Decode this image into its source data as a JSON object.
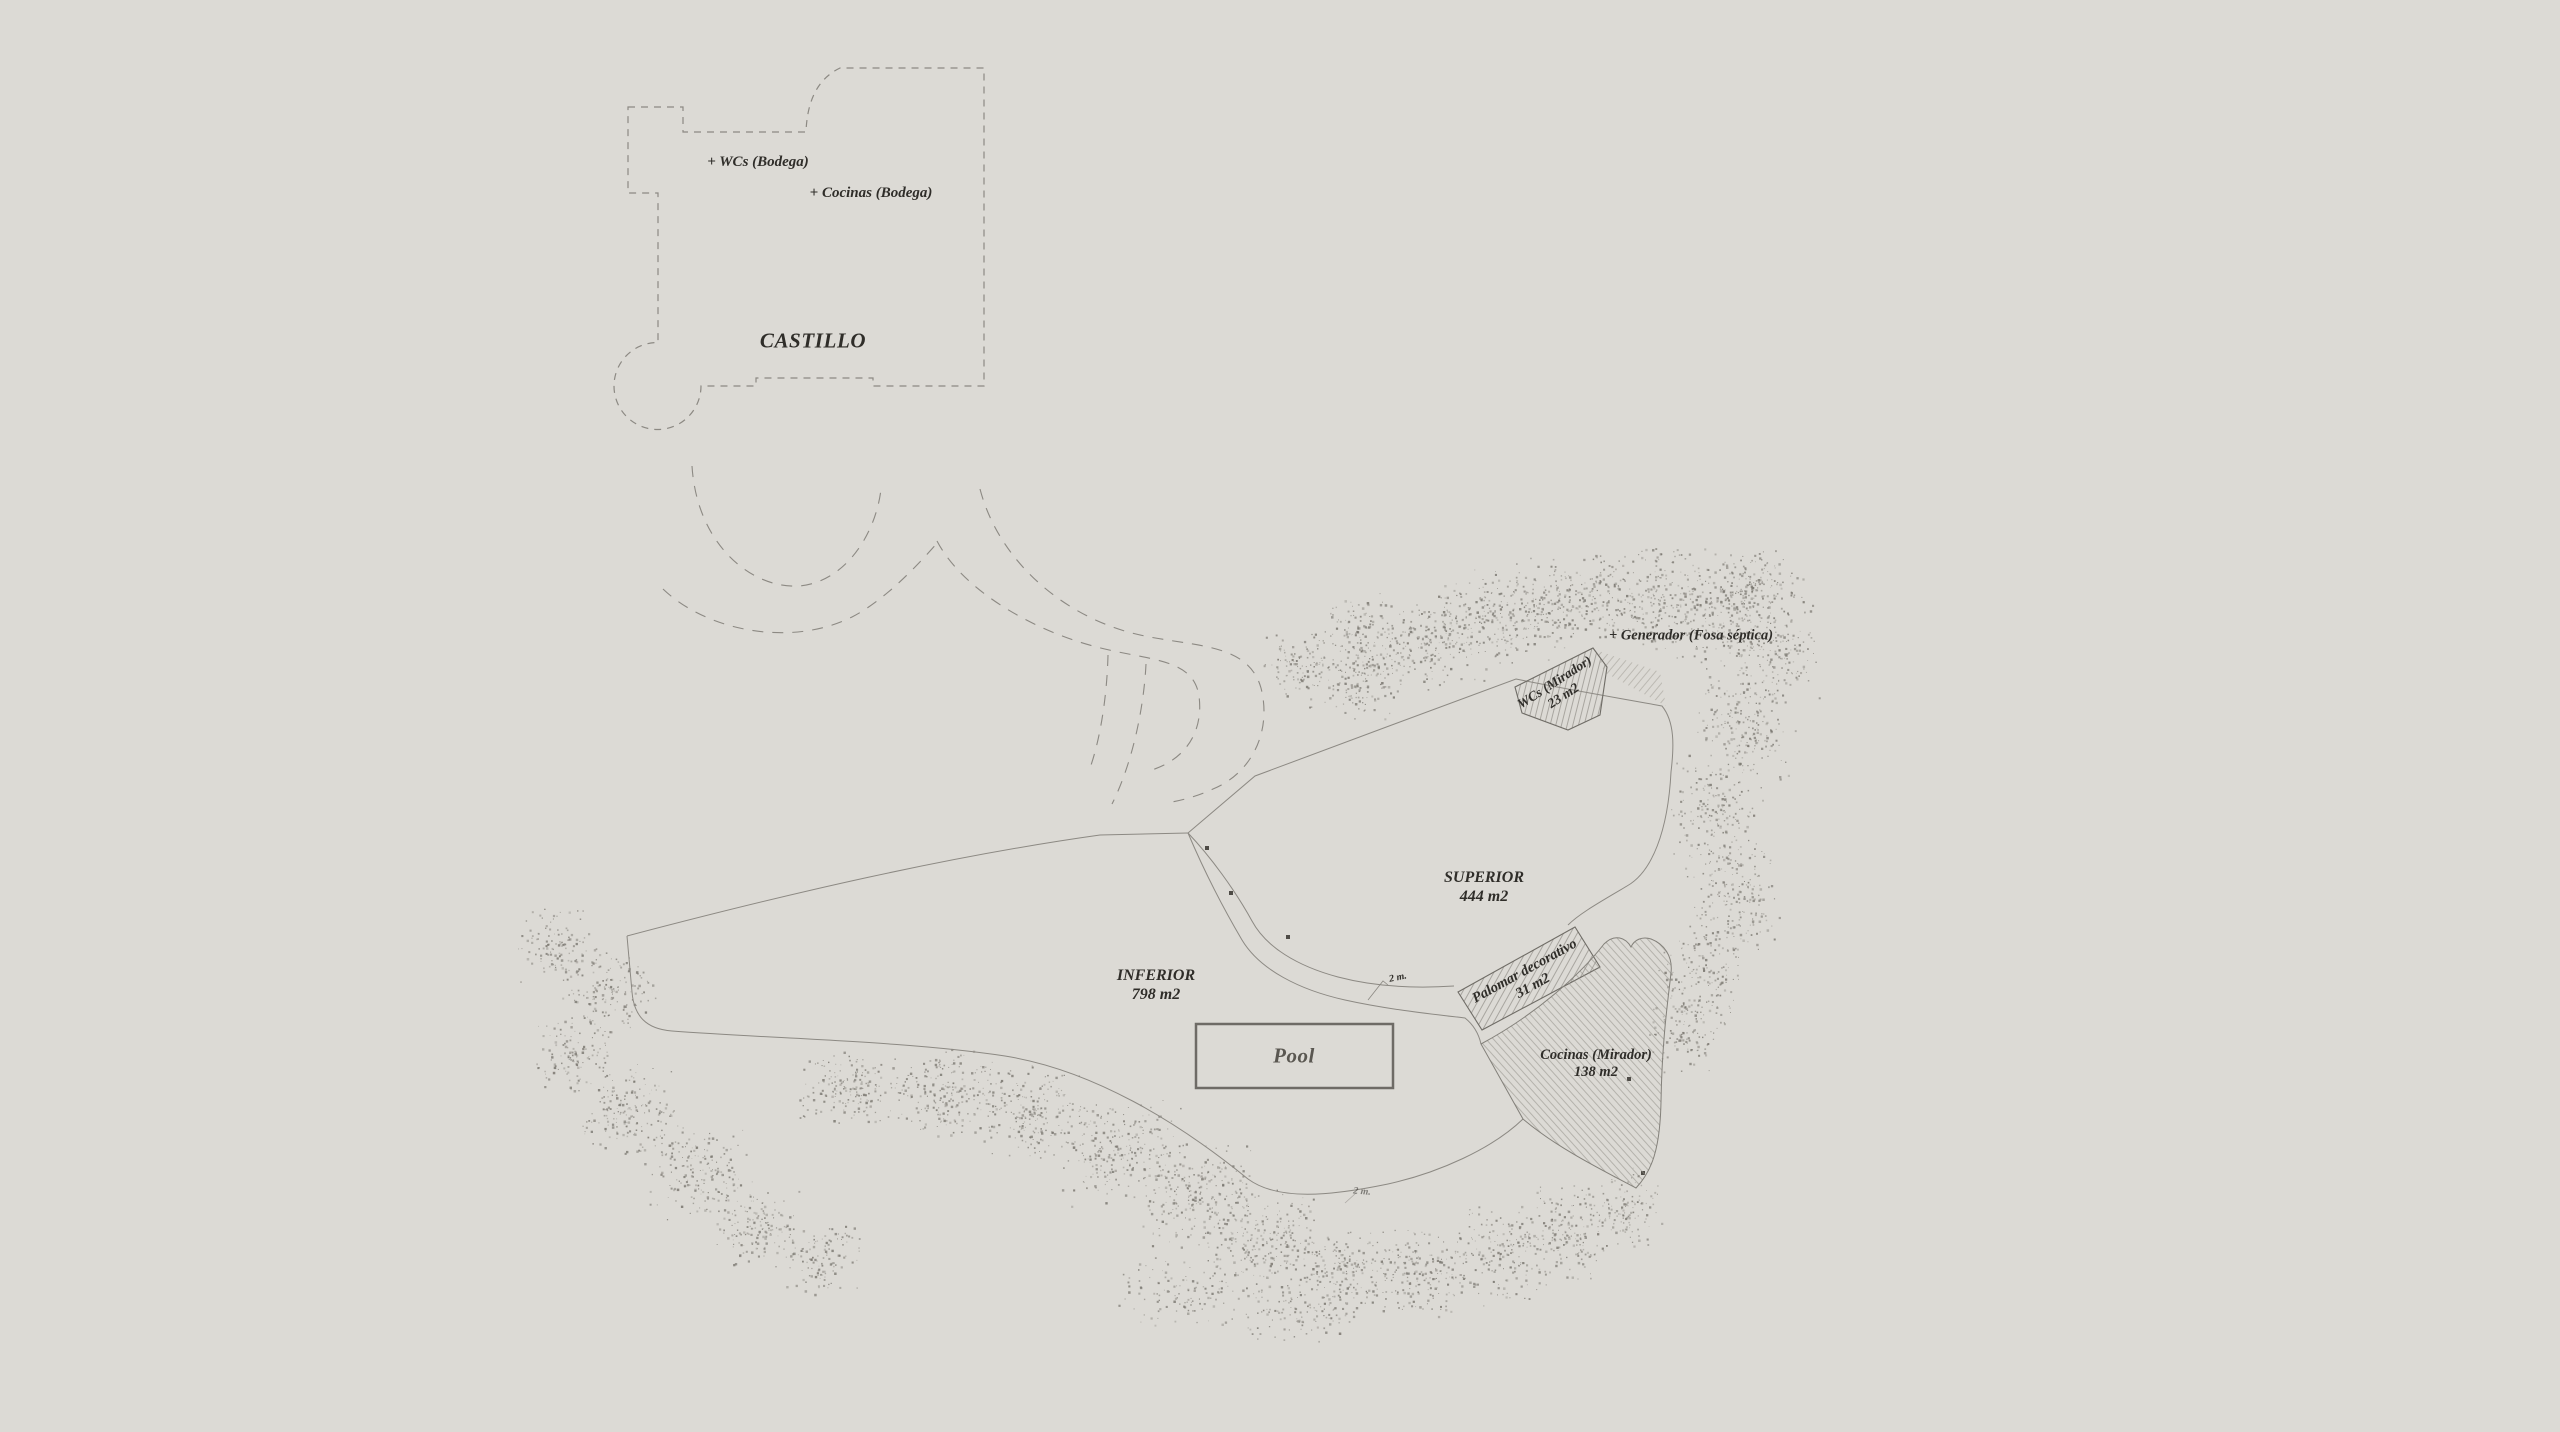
{
  "plan": {
    "castle_label": "CASTILLO",
    "wcs_bodega_label": "+ WCs (Bodega)",
    "cocinas_bodega_label": "+ Cocinas (Bodega)",
    "generador_label": "+ Generador (Fosa séptica)",
    "pool_label": "Pool",
    "zones": {
      "superior": {
        "name": "SUPERIOR",
        "area": "444 m2"
      },
      "inferior": {
        "name": "INFERIOR",
        "area": "798 m2"
      },
      "wcs_mirador": {
        "name": "WCs (Mirador)",
        "area": "23 m2"
      },
      "palomar": {
        "name": "Palomar decorativo",
        "area": "31 m2"
      },
      "cocinas_mirador": {
        "name": "Cocinas (Mirador)",
        "area": "138 m2"
      }
    },
    "path_width_labels": [
      "2 m.",
      "2 m."
    ],
    "colors": {
      "background": "#dcdad5",
      "line": "#8c8983",
      "text": "#2f2d29",
      "stipple": "#79766f",
      "pool_border": "#6e6b66",
      "pool_text": "#5a5751",
      "hatch": "#8f8c86"
    }
  }
}
